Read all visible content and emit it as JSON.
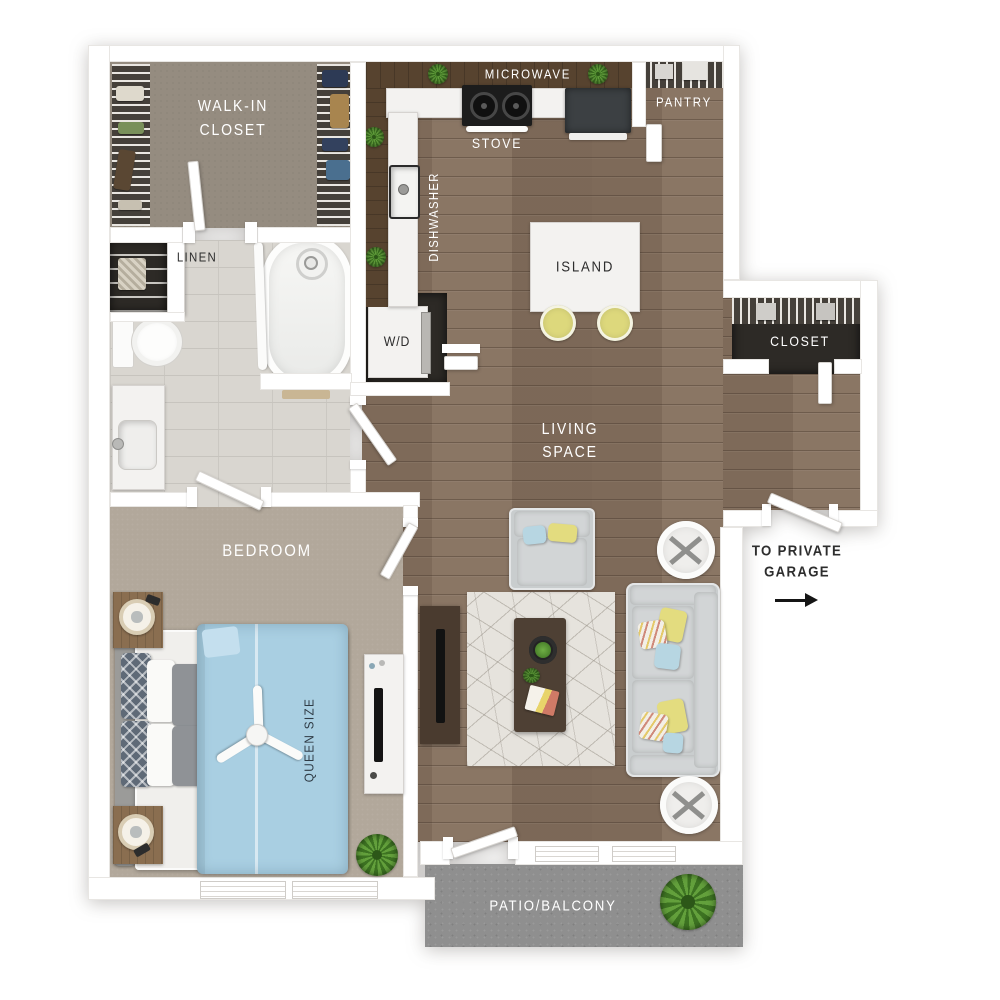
{
  "plan": {
    "type": "apartment-floor-plan",
    "labels": {
      "walk_in_closet_line1": "WALK-IN",
      "walk_in_closet_line2": "CLOSET",
      "linen": "LINEN",
      "microwave": "MICROWAVE",
      "stove": "STOVE",
      "pantry": "PANTRY",
      "dishwasher": "DISHWASHER",
      "washer_dryer": "W/D",
      "island": "ISLAND",
      "entry_closet": "CLOSET",
      "living_line1": "LIVING",
      "living_line2": "SPACE",
      "garage_line1": "TO PRIVATE",
      "garage_line2": "GARAGE",
      "bedroom": "BEDROOM",
      "bed_size": "QUEEN SIZE",
      "patio": "PATIO/BALCONY"
    },
    "colors": {
      "wood_floor": "#85705e",
      "bedroom_carpet": "#b2a89b",
      "closet_floor": "#958d80",
      "bathroom_tile": "#d9d6d0",
      "patio_concrete": "#8f8f8f",
      "wall": "#ffffff",
      "dark_closet_interior": "#2d2a26",
      "duvet_blue": "#a9cfe2",
      "accent_yellow": "#e3dc7f",
      "accent_blue": "#b7d6e2",
      "label_light": "#ffffff",
      "label_dark": "#2d2d2d"
    }
  }
}
